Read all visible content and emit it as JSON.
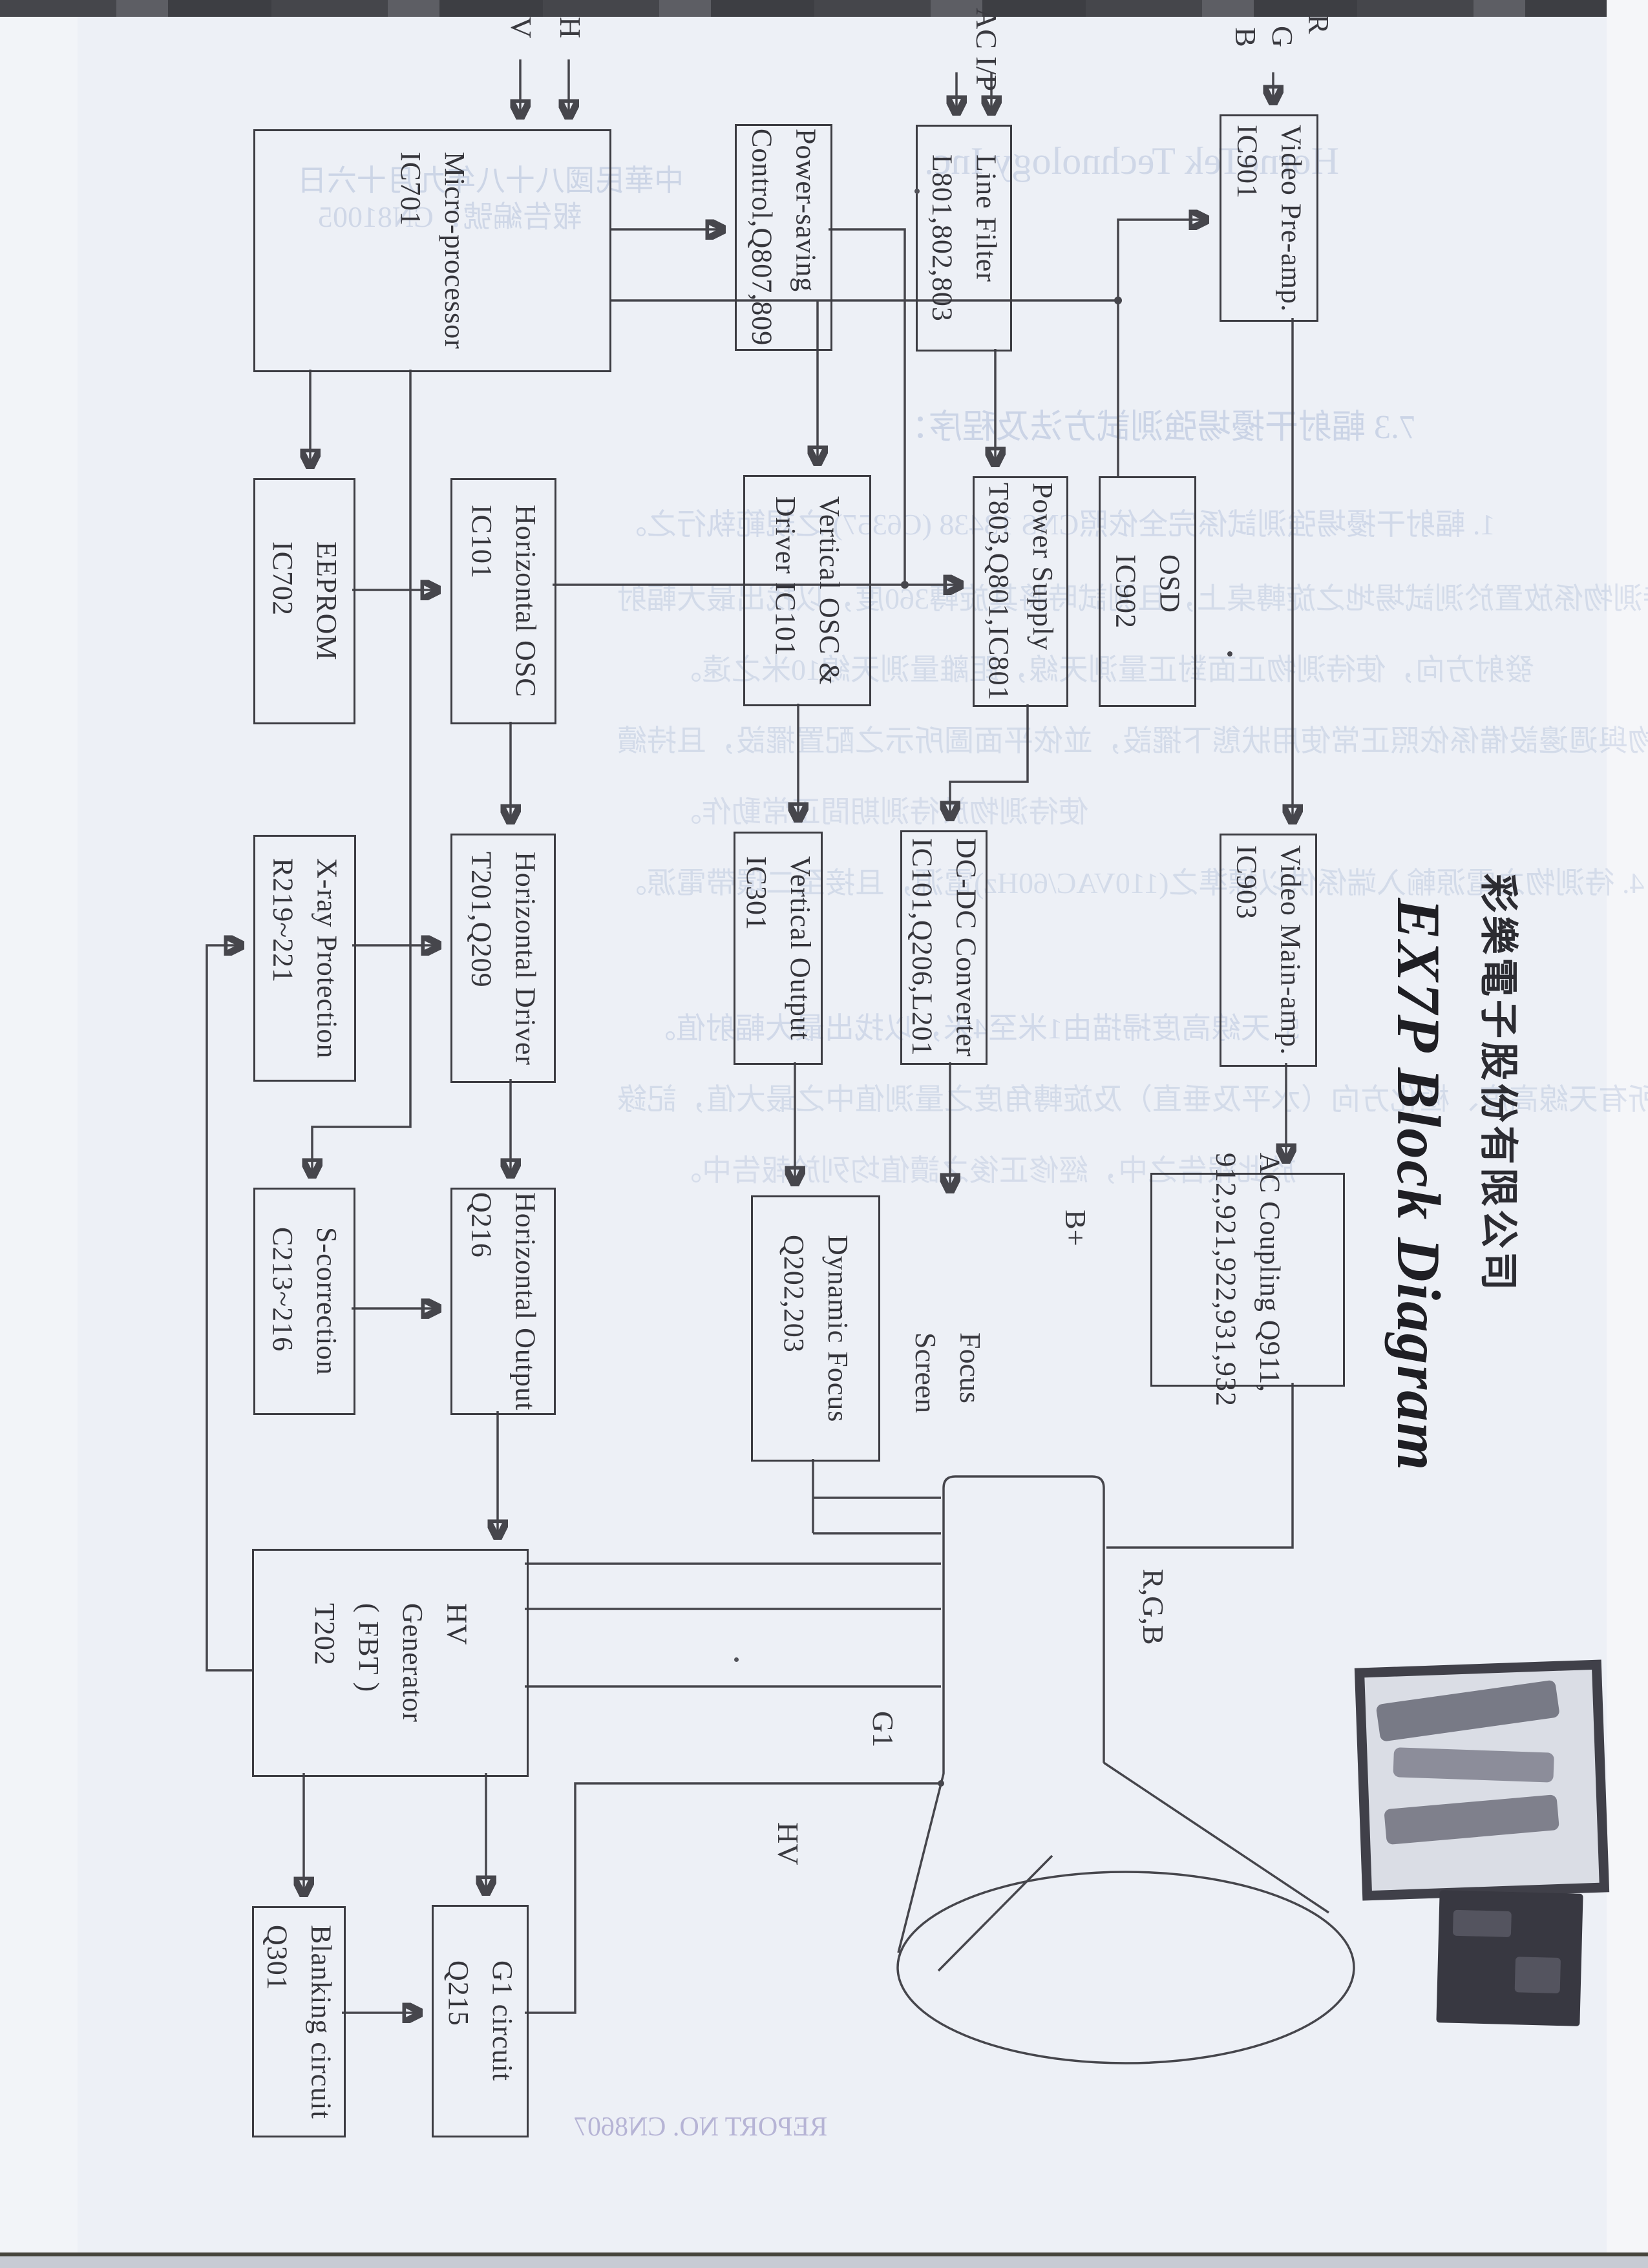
{
  "title": "EX7P Block Diagram",
  "company": "彩樂電子股份有限公司",
  "blocks": {
    "micro": [
      "Micro-processor",
      "IC701"
    ],
    "eeprom": [
      "EEPROM",
      "IC702"
    ],
    "hosc": [
      "Horizontal OSC",
      "IC101"
    ],
    "psave": [
      "Power-saving",
      "Control,Q807,809"
    ],
    "lfilter": [
      "Line Filter",
      "L801,802,803"
    ],
    "vpre": [
      "Video Pre-amp.",
      "IC901"
    ],
    "vosc": [
      "Vertical OSC &",
      "Driver IC101"
    ],
    "psupply": [
      "Power Supply",
      "T803,Q801,IC801"
    ],
    "osd": [
      "OSD",
      "IC902"
    ],
    "xray": [
      "X-ray Protection",
      "R219~221"
    ],
    "hdrv": [
      "Horizontal Driver",
      "T201,Q209"
    ],
    "vout": [
      "Vertical Output",
      "IC301"
    ],
    "ddc": [
      "DC-DC Converter",
      "IC101,Q206,L201"
    ],
    "vmain": [
      "Video Main-amp.",
      "IC903"
    ],
    "scorr": [
      "S-correction",
      "C213~216"
    ],
    "hout": [
      "Horizontal Output",
      "Q216"
    ],
    "dfocus": [
      "Dynamic Focus",
      "Q202,203"
    ],
    "acc": [
      "AC Coupling Q911,",
      "912,921,922,931,932"
    ],
    "hvgen": [
      "HV",
      "Generator",
      "( FBT )",
      "T202"
    ],
    "blank": [
      "Blanking circuit",
      "Q301"
    ],
    "g1c": [
      "G1 circuit",
      "Q215"
    ]
  },
  "ports": {
    "v": "V",
    "h": "H",
    "ac_ip": "AC I/P",
    "r": "R",
    "g": "G",
    "b": "B",
    "b_plus": "B+",
    "g1": "G1",
    "hv": "HV",
    "focus": "Focus",
    "screen": "Screen",
    "rgb": "R,G,B"
  },
  "bleedthrough": [
    "中華民國八十八年九月十六日",
    "報告編號：CN81005",
    "HorneTek Technology Inc.",
    "7.3 輻射干擾場強測試方法及程序：",
    "1. 輻射干擾場強測試係完全依照CNS 13438 (C6357) 之規範執行之。",
    "2. 待測物係放置於測試場地之旋轉桌上，且測試時將其旋轉360度，以找出最大輻射",
    "發射方向，使待測物正面對正量測天線，距離量測天線10米之遠。",
    "3. 待測物與週邊設備係依照正常使用狀態下擺設，並依平面圖所示之配置擺設，且持續",
    "使待測物於待測期間正常動作。",
    "4. 待測物之電源輸入端係供以標準之(110VAC/60Hz)電源，且接至二環帶電源。",
    "5. 天線高度掃描由1米至4米，以找出最大輻射值。",
    "6. 所有天線高度、極化方向（水平及垂直）及旋轉角度之量測值中之最大值，記錄",
    "於此報告之中，經修正後之讀值均列於報告中。"
  ],
  "footer_mirrored": "REPORT NO. CN8607"
}
